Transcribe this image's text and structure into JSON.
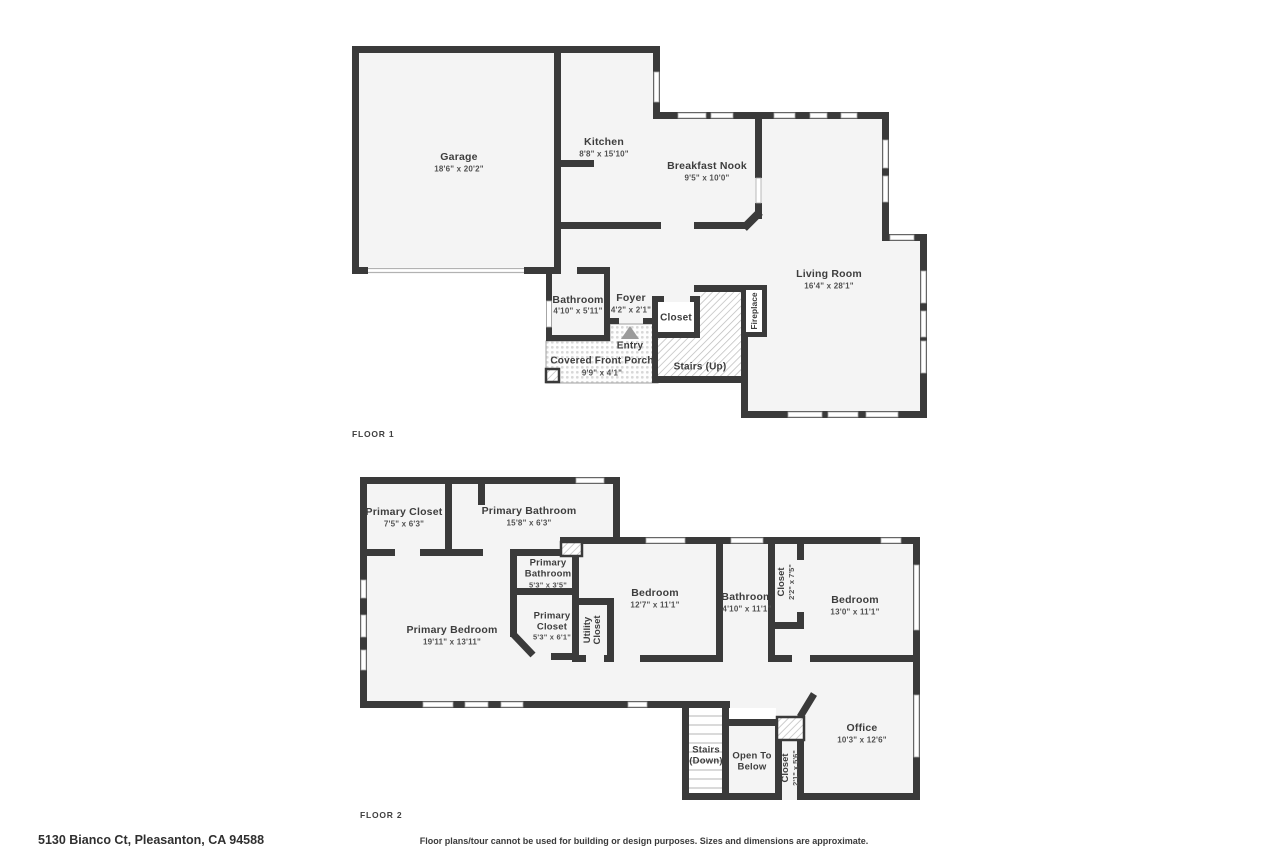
{
  "footer": {
    "address": "5130 Bianco Ct, Pleasanton, CA 94588",
    "disclaimer": "Floor plans/tour cannot be used for building or design purposes. Sizes and dimensions are approximate."
  },
  "colors": {
    "wall": "#3a3a3a",
    "room_fill": "#f4f4f4",
    "text": "#3d3d3d",
    "dim_text": "#515151",
    "hatch_line": "#b9b9b9",
    "porch_dot": "#d7d7d7",
    "entry_arrow": "#9b9b9b",
    "window_frame": "#a8a8a8"
  },
  "floor1": {
    "label": "FLOOR 1",
    "rooms": {
      "garage": {
        "name": "Garage",
        "dims": "18'6\" x 20'2\""
      },
      "kitchen": {
        "name": "Kitchen",
        "dims": "8'8\" x 15'10\""
      },
      "breakfast_nook": {
        "name": "Breakfast Nook",
        "dims": "9'5\" x 10'0\""
      },
      "living_room": {
        "name": "Living Room",
        "dims": "16'4\" x 28'1\""
      },
      "bathroom": {
        "name": "Bathroom",
        "dims": "4'10\" x 5'11\""
      },
      "foyer": {
        "name": "Foyer",
        "dims": "4'2\" x 2'1\""
      },
      "closet": {
        "name": "Closet"
      },
      "fireplace": {
        "name": "Fireplace"
      },
      "stairs_up": {
        "name": "Stairs (Up)"
      },
      "entry": {
        "name": "Entry"
      },
      "porch": {
        "name": "Covered Front Porch",
        "dims": "9'9\" x 4'1\""
      }
    }
  },
  "floor2": {
    "label": "FLOOR 2",
    "rooms": {
      "primary_closet": {
        "name": "Primary Closet",
        "dims": "7'5\" x 6'3\""
      },
      "primary_bathroom": {
        "name": "Primary Bathroom",
        "dims": "15'8\" x 6'3\""
      },
      "primary_bathroom_small": {
        "name_line1": "Primary",
        "name_line2": "Bathroom",
        "dims": "5'3\" x 3'5\""
      },
      "primary_closet_small": {
        "name_line1": "Primary",
        "name_line2": "Closet",
        "dims": "5'3\" x 6'1\""
      },
      "utility_closet": {
        "name_line1": "Utility",
        "name_line2": "Closet"
      },
      "primary_bedroom": {
        "name": "Primary Bedroom",
        "dims": "19'11\" x 13'11\""
      },
      "bedroom_left": {
        "name": "Bedroom",
        "dims": "12'7\" x 11'1\""
      },
      "bathroom": {
        "name": "Bathroom",
        "dims": "4'10\" x 11'1\""
      },
      "closet_hall": {
        "name": "Closet",
        "dims": "2'2\" x 7'5\""
      },
      "bedroom_right": {
        "name": "Bedroom",
        "dims": "13'0\" x 11'1\""
      },
      "office": {
        "name": "Office",
        "dims": "10'3\" x 12'6\""
      },
      "stairs_down": {
        "name_line1": "Stairs",
        "name_line2": "(Down)"
      },
      "open_to_below": {
        "name_line1": "Open To",
        "name_line2": "Below"
      },
      "closet_bottom": {
        "name": "Closet",
        "dims": "2'1\" x 5'6\""
      }
    }
  }
}
